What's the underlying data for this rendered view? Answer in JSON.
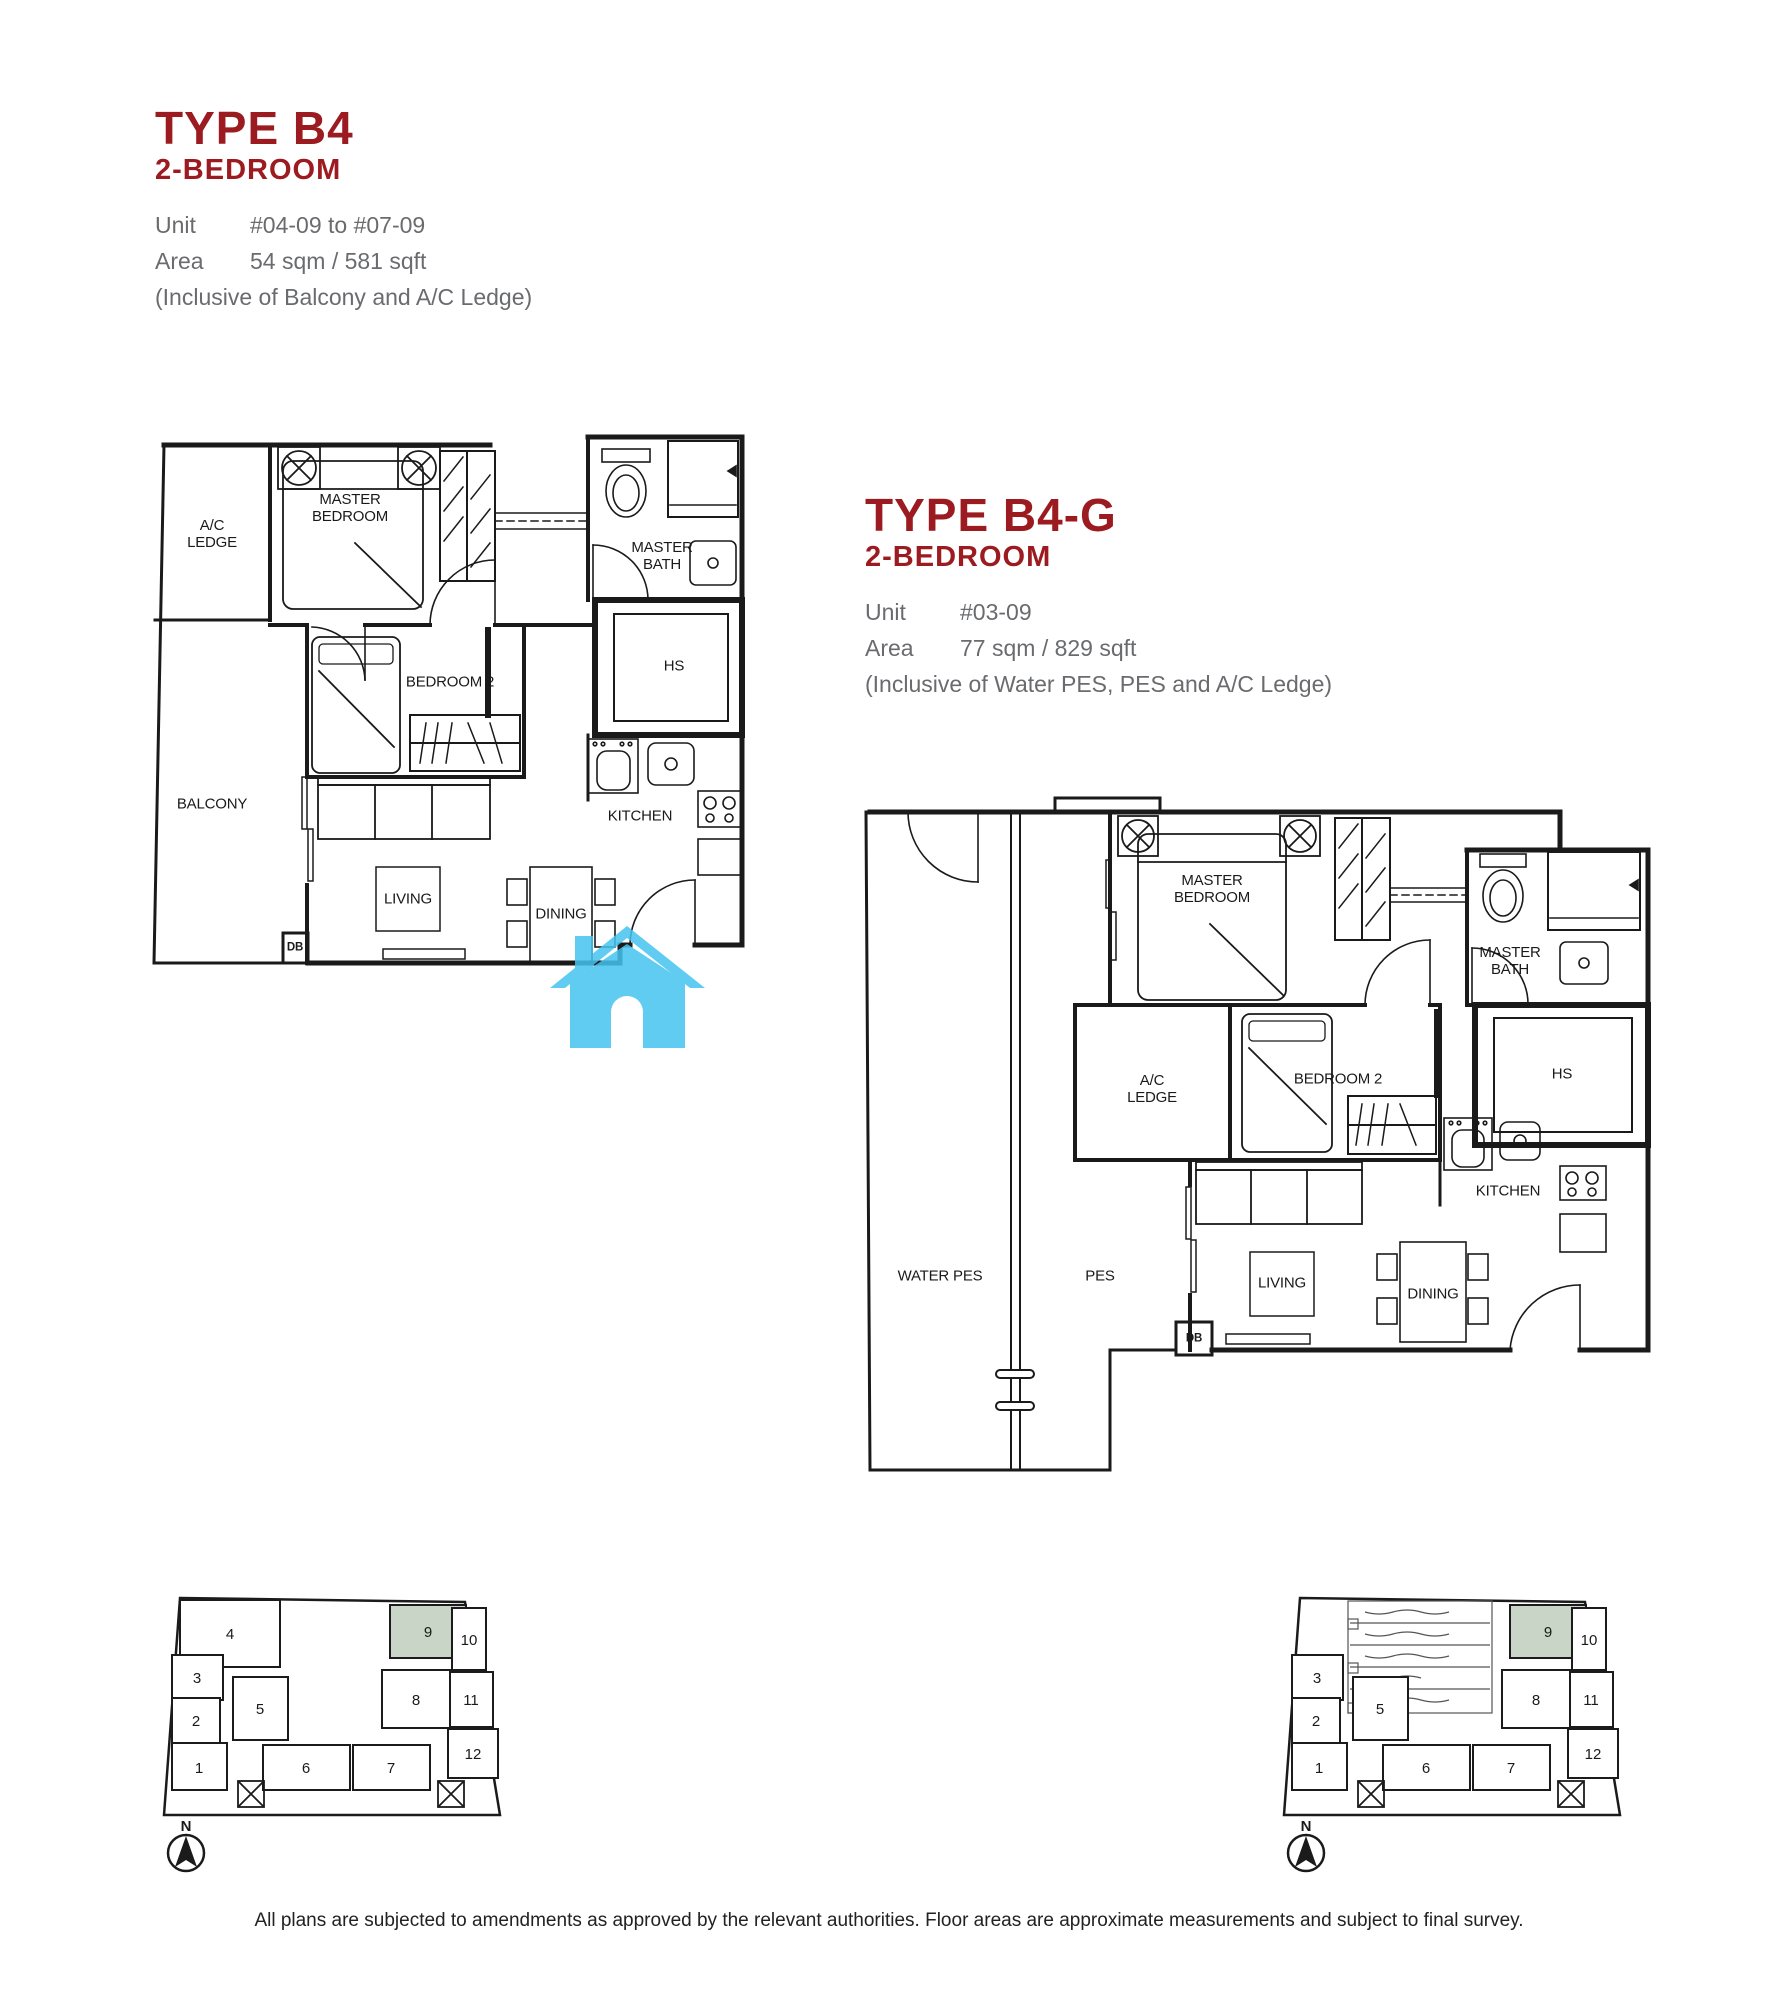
{
  "colors": {
    "accent": "#9c1b20",
    "muted": "#6a6b6e",
    "ink": "#1a1a1a",
    "highlight": "#c9d5c6",
    "watermark": "#45c4f0"
  },
  "plans": [
    {
      "title": "TYPE B4",
      "subtitle": "2-BEDROOM",
      "unit_label": "Unit",
      "unit": "#04-09 to #07-09",
      "area_label": "Area",
      "area": "54 sqm / 581 sqft",
      "note": "(Inclusive of Balcony and A/C Ledge)",
      "rooms": {
        "ac_ledge": "A/C LEDGE",
        "master_bedroom": "MASTER BEDROOM",
        "master_bath": "MASTER BATH",
        "hs": "HS",
        "bedroom2": "BEDROOM 2",
        "balcony": "BALCONY",
        "kitchen": "KITCHEN",
        "living": "LIVING",
        "dining": "DINING",
        "db": "DB"
      }
    },
    {
      "title": "TYPE B4-G",
      "subtitle": "2-BEDROOM",
      "unit_label": "Unit",
      "unit": "#03-09",
      "area_label": "Area",
      "area": "77 sqm / 829 sqft",
      "note": "(Inclusive of Water PES, PES and A/C Ledge)",
      "rooms": {
        "water_pes": "WATER PES",
        "pes": "PES",
        "ac_ledge": "A/C LEDGE",
        "master_bedroom": "MASTER BEDROOM",
        "master_bath": "MASTER BATH",
        "hs": "HS",
        "bedroom2": "BEDROOM 2",
        "kitchen": "KITCHEN",
        "living": "LIVING",
        "dining": "DINING",
        "db": "DB"
      }
    }
  ],
  "keyplan": {
    "north": "N",
    "highlighted_unit": "9",
    "units": [
      "1",
      "2",
      "3",
      "4",
      "5",
      "6",
      "7",
      "8",
      "9",
      "10",
      "11",
      "12"
    ]
  },
  "footer": {
    "disclaimer": "All plans are subjected to amendments as approved by the relevant authorities. Floor areas are approximate measurements and subject to final survey."
  }
}
